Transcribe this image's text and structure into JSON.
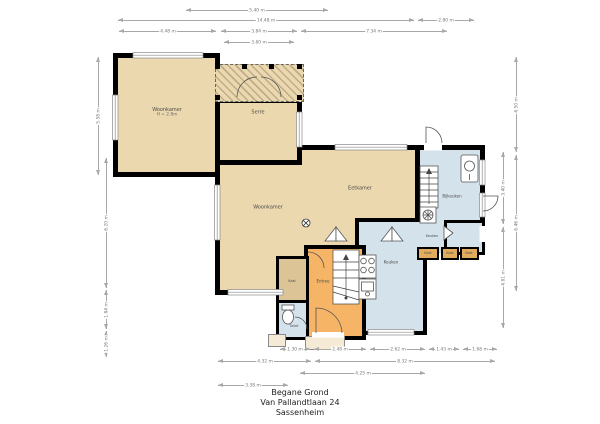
{
  "title": {
    "line1": "Begane Grond",
    "line2": "Van Pallandtlaan 24",
    "line3": "Sassenheim"
  },
  "rooms": {
    "woonkamer_left": {
      "label": "Woonkamer",
      "sub": "H = 2.8m"
    },
    "serre": {
      "label": "Serre"
    },
    "woonkamer": {
      "label": "Woonkamer"
    },
    "eetkamer": {
      "label": "Eetkamer"
    },
    "bijkeuken": {
      "label": "Bijkeuken"
    },
    "keuken_upper": {
      "label": "Keuken"
    },
    "keuken": {
      "label": "Keuken"
    },
    "entree": {
      "label": "Entree"
    },
    "kast": {
      "label": "Kast"
    },
    "toilet": {
      "label": "Toilet"
    },
    "kast1": {
      "label": "Kast"
    },
    "kast2": {
      "label": "Kast"
    },
    "kast3": {
      "label": "Kast"
    }
  },
  "colors": {
    "tan": "#ecd8ae",
    "orange": "#f6b566",
    "blue": "#d4e2ec",
    "closet_tan": "#dcc497",
    "closet_orange": "#e2ac5e",
    "wall": "#000000",
    "dimension_gray": "#a8a8a8",
    "label_gray": "#4a4a4a"
  },
  "dimensions": [
    {
      "label": "5.40 m",
      "o": "h",
      "x": 186,
      "y": 6,
      "len": 142
    },
    {
      "label": "14.48 m",
      "o": "h",
      "x": 118,
      "y": 16,
      "len": 296
    },
    {
      "label": "2.80 m",
      "o": "h",
      "x": 418,
      "y": 16,
      "len": 56
    },
    {
      "label": "4.48 m",
      "o": "h",
      "x": 119,
      "y": 27,
      "len": 97
    },
    {
      "label": "3.84 m",
      "o": "h",
      "x": 221,
      "y": 27,
      "len": 76
    },
    {
      "label": "7.34 m",
      "o": "h",
      "x": 301,
      "y": 27,
      "len": 146
    },
    {
      "label": "3.60 m",
      "o": "h",
      "x": 224,
      "y": 38,
      "len": 70
    },
    {
      "label": "1.30 m",
      "o": "h",
      "x": 280,
      "y": 345,
      "len": 30
    },
    {
      "label": "2.48 m",
      "o": "h",
      "x": 314,
      "y": 345,
      "len": 52
    },
    {
      "label": "2.62 m",
      "o": "h",
      "x": 370,
      "y": 345,
      "len": 55
    },
    {
      "label": "1.43 m",
      "o": "h",
      "x": 429,
      "y": 345,
      "len": 30
    },
    {
      "label": "1.68 m",
      "o": "h",
      "x": 463,
      "y": 345,
      "len": 34
    },
    {
      "label": "4.32 m",
      "o": "h",
      "x": 218,
      "y": 357,
      "len": 93
    },
    {
      "label": "8.32 m",
      "o": "h",
      "x": 315,
      "y": 357,
      "len": 180
    },
    {
      "label": "4.25 m",
      "o": "h",
      "x": 300,
      "y": 369,
      "len": 125
    },
    {
      "label": "3.38 m",
      "o": "h",
      "x": 218,
      "y": 381,
      "len": 70
    },
    {
      "label": "5.58 m",
      "o": "v",
      "x": 94,
      "y": 57,
      "len": 118
    },
    {
      "label": "6.20 m",
      "o": "v",
      "x": 102,
      "y": 158,
      "len": 130
    },
    {
      "label": "1.84 m",
      "o": "v",
      "x": 102,
      "y": 290,
      "len": 39
    },
    {
      "label": "1.26 m",
      "o": "v",
      "x": 102,
      "y": 331,
      "len": 26
    },
    {
      "label": "4.50 m",
      "o": "v",
      "x": 512,
      "y": 57,
      "len": 95
    },
    {
      "label": "6.46 m",
      "o": "v",
      "x": 512,
      "y": 155,
      "len": 136
    },
    {
      "label": "3.40 m",
      "o": "v",
      "x": 499,
      "y": 152,
      "len": 72
    },
    {
      "label": "4.81 m",
      "o": "v",
      "x": 499,
      "y": 227,
      "len": 101
    }
  ]
}
